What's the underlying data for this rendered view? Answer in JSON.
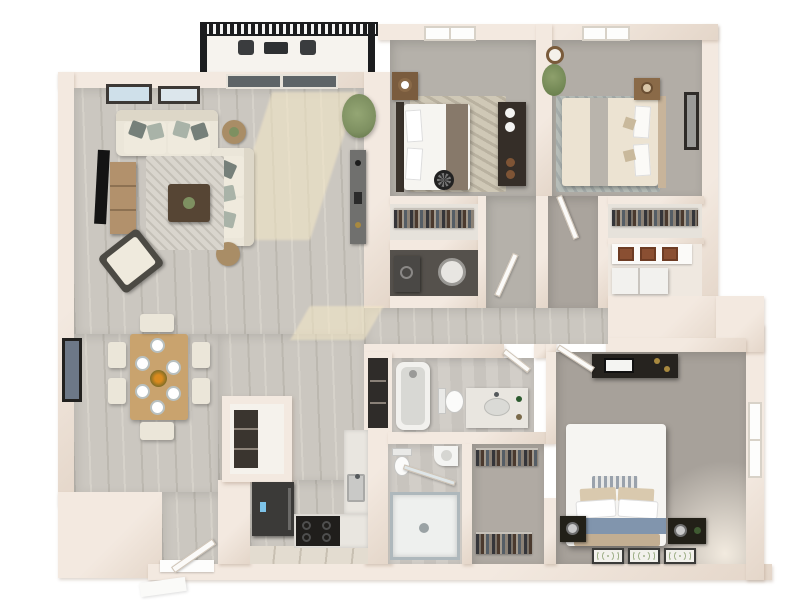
{
  "scene": {
    "type": "3d-floor-plan-rendering",
    "view": "top-down birds-eye",
    "rooms": [
      {
        "name": "balcony",
        "items": [
          "railing",
          "patio-chair",
          "patio-chair",
          "patio-table"
        ]
      },
      {
        "name": "living-room",
        "items": [
          "wall-art",
          "wall-art",
          "sliding-glass-door",
          "sofa",
          "loveseat",
          "round-side-table",
          "round-side-table",
          "tv",
          "tv-stand",
          "area-rug",
          "coffee-table",
          "armchair",
          "console-table",
          "potted-plant",
          "sunlight-patch"
        ]
      },
      {
        "name": "dining-area",
        "items": [
          "wall-art",
          "dining-table",
          "place-setting-x6",
          "centerpiece",
          "dining-chair-x6"
        ]
      },
      {
        "name": "kitchen",
        "items": [
          "pantry",
          "refrigerator",
          "range",
          "counter",
          "sink",
          "tile-floor"
        ]
      },
      {
        "name": "entry",
        "items": [
          "front-door",
          "threshold",
          "exterior-step"
        ]
      },
      {
        "name": "hallway",
        "items": [
          "sunlight-patch"
        ]
      },
      {
        "name": "bedroom-2",
        "items": [
          "window",
          "bed",
          "headboard",
          "nightstand",
          "table-lamp",
          "dresser",
          "vases",
          "area-rug",
          "floor-fan",
          "door"
        ]
      },
      {
        "name": "bedroom-2-closet",
        "items": [
          "clothes-rod"
        ]
      },
      {
        "name": "laundry-closet",
        "items": [
          "washer",
          "water-heater"
        ]
      },
      {
        "name": "bedroom-3",
        "items": [
          "window",
          "bed",
          "nightstand",
          "table-lamp",
          "wall-clock",
          "potted-plant",
          "wall-art",
          "area-rug",
          "door"
        ]
      },
      {
        "name": "bedroom-3-closet",
        "items": [
          "clothes-rod",
          "basket-shelf",
          "storage-cabinet"
        ]
      },
      {
        "name": "linen-closet",
        "items": [
          "shelves"
        ]
      },
      {
        "name": "bathroom-1",
        "items": [
          "bathtub",
          "toilet",
          "vanity-sink",
          "door"
        ]
      },
      {
        "name": "bathroom-2",
        "items": [
          "toilet",
          "corner-sink",
          "shower"
        ]
      },
      {
        "name": "walk-in-closet",
        "items": [
          "clothes-rod",
          "clothes-rod"
        ]
      },
      {
        "name": "master-bedroom",
        "items": [
          "media-console",
          "tv",
          "window",
          "bed",
          "pillows",
          "blue-throw",
          "bench",
          "nightstand",
          "nightstand",
          "table-lamp",
          "table-lamp",
          "accent-rug",
          "accent-rug",
          "accent-rug",
          "door"
        ]
      }
    ]
  },
  "palette": {
    "bg": "#ffffff",
    "wall": "#f3e9e0",
    "wall-shade": "#e4d6c9",
    "wood-a": "#cbc7c0",
    "wood-b": "#bcb8b0",
    "wood-c": "#d6d2ca",
    "tile-a": "#e3dcd0",
    "tile-b": "#c8c0b2",
    "bath-a": "#d2cec8",
    "bath-b": "#c8c4be",
    "carpet-bed2": "#b5b1aa",
    "carpet-bed3": "#b2ada6",
    "carpet-master": "#a7a19a",
    "carpet-hall": "#aaa49d",
    "closet-floor": "#e6e2db",
    "laundry-floor": "#55514c",
    "rug-living": "#d9d5cd",
    "rug-bed2": "#cfc8b6",
    "rug-bed3": "#b7bdb8",
    "sofa": "#ebe6d9",
    "dark-furniture": "#332f2a",
    "railing": "#1c1d1f",
    "glass": "#5e6467",
    "plant": "#7e9061",
    "wood-table": "#c9a36e",
    "tv-stand": "#b2916c",
    "coffee-table": "#564534",
    "blue-throw": "#8195ad",
    "tan": "#c2ae92",
    "appliance-black": "#201e1c",
    "fridge": "#3b3a38",
    "marble": "#e9e6e0"
  }
}
